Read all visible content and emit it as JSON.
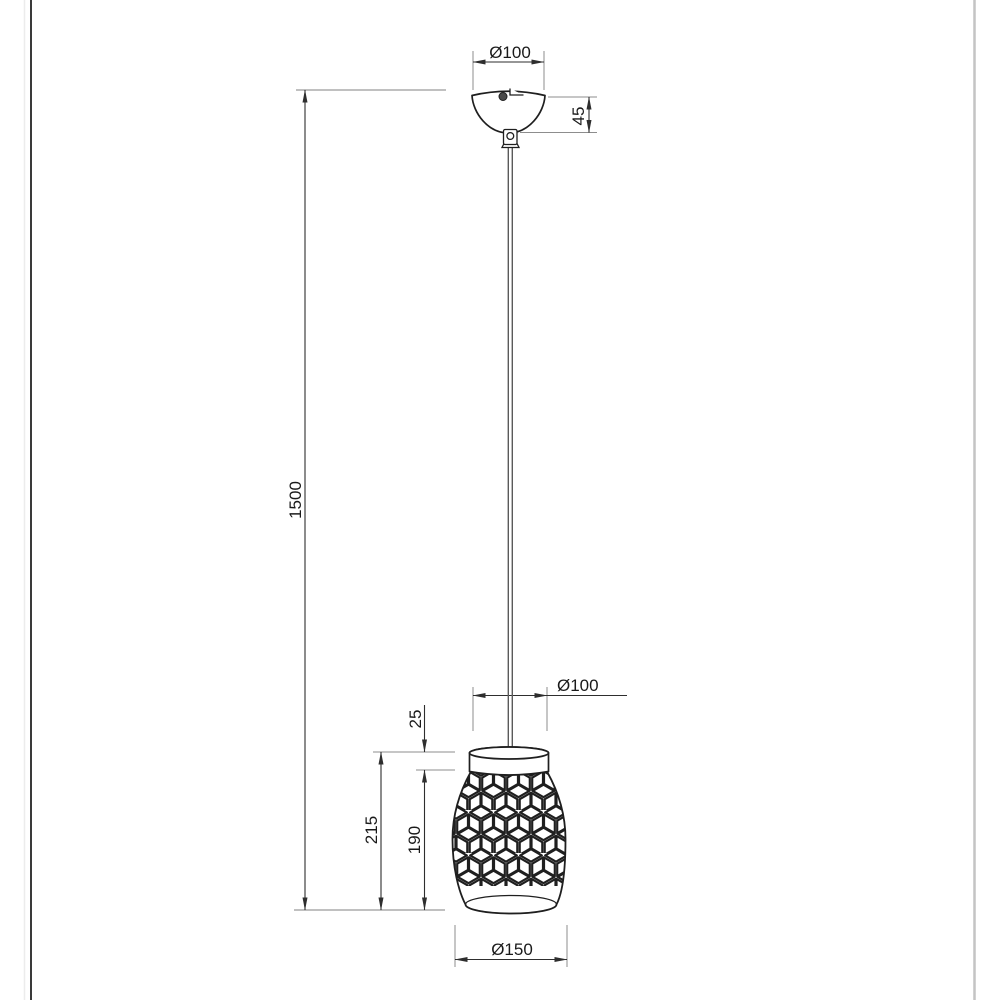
{
  "drawing": {
    "dimensions": {
      "canopy_diameter": "Ø100",
      "canopy_height": "45",
      "suspension_length": "1500",
      "shade_top_diameter": "Ø100",
      "shade_cap_height": "25",
      "shade_total_height": "215",
      "shade_body_height": "190",
      "shade_bottom_diameter": "Ø150"
    },
    "colors": {
      "outline": "#1f1f1f",
      "dimension": "#2e2e2e",
      "extension": "#8d8d8d",
      "cable": "#5a5a5a",
      "text": "#1a1a1a",
      "frame_dark": "#3a3a3a",
      "frame_light": "#c4c4c4",
      "background": "#ffffff"
    }
  }
}
